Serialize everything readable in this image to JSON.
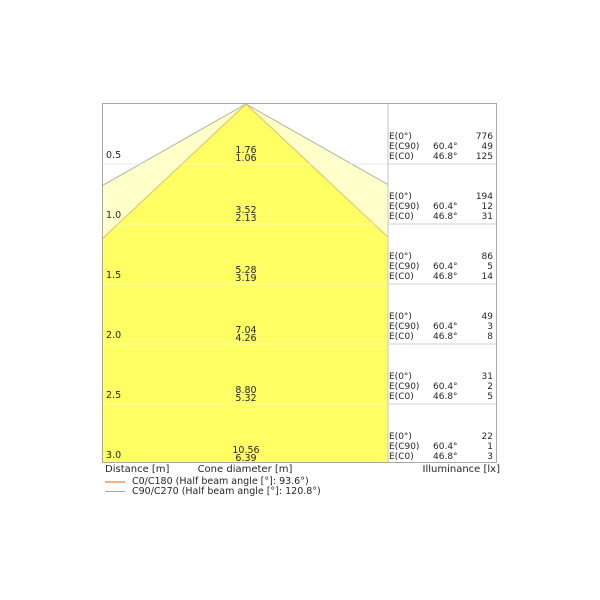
{
  "chart_data": {
    "type": "table",
    "title": "Luminaire light cone diagram",
    "columns": [
      "Distance [m]",
      "Cone diameter C90/C270 [m]",
      "Cone diameter C0/C180 [m]",
      "E(0°) [lx]",
      "E(C90) [lx]",
      "E(C0) [lx]"
    ],
    "rows": [
      [
        0.5,
        1.76,
        1.06,
        776,
        49,
        125
      ],
      [
        1.0,
        3.52,
        2.13,
        194,
        12,
        31
      ],
      [
        1.5,
        5.28,
        3.19,
        86,
        5,
        14
      ],
      [
        2.0,
        7.04,
        4.26,
        49,
        3,
        8
      ],
      [
        2.5,
        8.8,
        5.32,
        31,
        2,
        5
      ],
      [
        3.0,
        10.56,
        6.39,
        22,
        1,
        3
      ]
    ],
    "beam_half_angles": {
      "E(C90)": "60.4°",
      "E(C0)": "46.8°"
    },
    "legend": [
      "C0/C180 (Half beam angle [°]: 93.6°)",
      "C90/C270 (Half beam angle [°]: 120.8°)"
    ],
    "axis_labels": [
      "Distance [m]",
      "Cone diameter [m]",
      "Illuminance [lx]"
    ],
    "grid": true,
    "legend_position": "bottom-left"
  },
  "diagram": {
    "axis": {
      "distance": "Distance [m]",
      "cone": "Cone diameter [m]",
      "illuminance": "Illuminance [lx]"
    },
    "illum_labels": {
      "e0": "E(0°)",
      "ec90": "E(C90)",
      "ec0": "E(C0)"
    },
    "angles": {
      "c90": "60.4°",
      "c0": "46.8°"
    },
    "rows": [
      {
        "distance": "0.5",
        "cone_c90": "1.76",
        "cone_c0": "1.06",
        "e0": "776",
        "ec90": "49",
        "ec0": "125"
      },
      {
        "distance": "1.0",
        "cone_c90": "3.52",
        "cone_c0": "2.13",
        "e0": "194",
        "ec90": "12",
        "ec0": "31"
      },
      {
        "distance": "1.5",
        "cone_c90": "5.28",
        "cone_c0": "3.19",
        "e0": "86",
        "ec90": "5",
        "ec0": "14"
      },
      {
        "distance": "2.0",
        "cone_c90": "7.04",
        "cone_c0": "4.26",
        "e0": "49",
        "ec90": "3",
        "ec0": "8"
      },
      {
        "distance": "2.5",
        "cone_c90": "8.80",
        "cone_c0": "5.32",
        "e0": "31",
        "ec90": "2",
        "ec0": "5"
      },
      {
        "distance": "3.0",
        "cone_c90": "10.56",
        "cone_c0": "6.39",
        "e0": "22",
        "ec90": "1",
        "ec0": "3"
      }
    ],
    "legend": [
      {
        "label": "C0/C180 (Half beam angle [°]: 93.6°)",
        "color": "#f0b47e"
      },
      {
        "label": "C90/C270 (Half beam angle [°]: 120.8°)",
        "color": "#a3a3a3"
      }
    ],
    "colors": {
      "cone_inner": "#ffff63",
      "cone_outer": "#ffffc9",
      "edge_c0": "#ddbe72",
      "edge_c90": "#b3b3a2"
    }
  }
}
